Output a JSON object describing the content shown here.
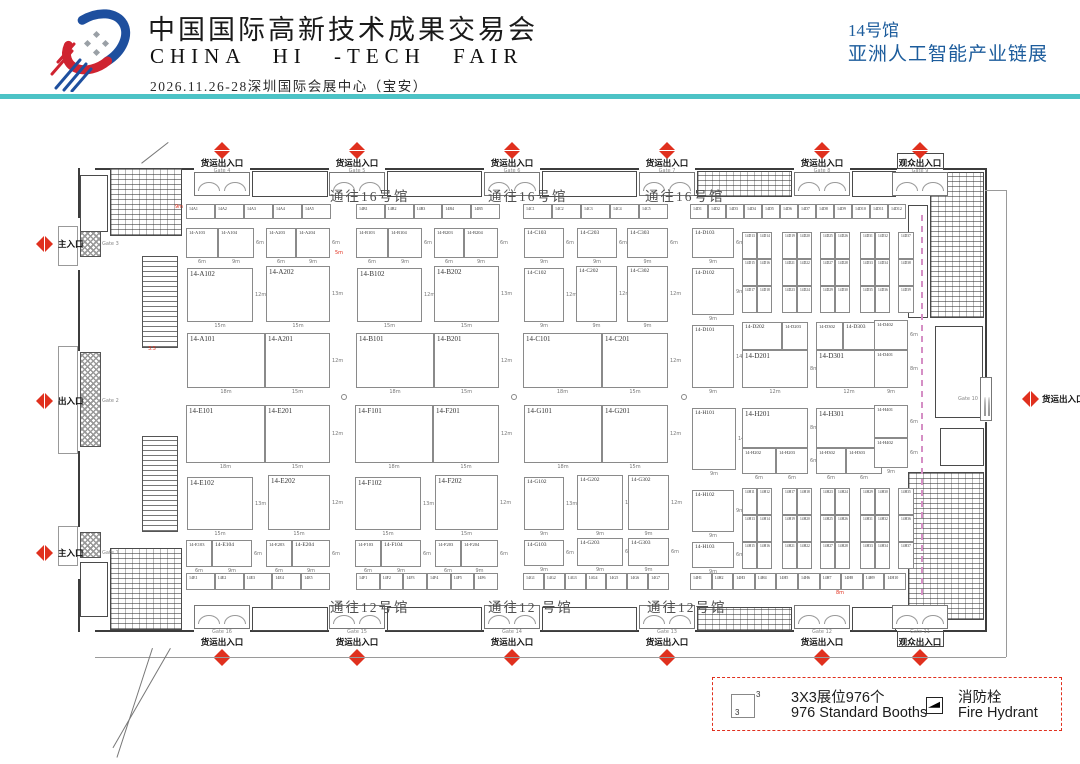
{
  "header": {
    "title_cn": "中国国际高新技术成果交易会",
    "title_en": "CHINA HI -TECH FAIR",
    "subtitle": "2026.11.26-28深圳国际会展中心（宝安）",
    "hall_no": "14号馆",
    "hall_name": "亚洲人工智能产业链展"
  },
  "colors": {
    "accent_teal": "#4cc3c6",
    "header_blue": "#1c5c9c",
    "marker_red": "#e0301e",
    "dashed_pink": "#d58fc5"
  },
  "legend": {
    "booth_icon_label": "3",
    "booth_icon_sup": "3",
    "item1_cn": "3X3展位976个",
    "item1_en": "976 Standard Booths",
    "item2_cn": "消防栓",
    "item2_en": "Fire Hydrant"
  },
  "plan": {
    "corridor_labels": [
      {
        "text": "通往16号馆",
        "x": 330,
        "y": 185
      },
      {
        "text": "通往16号馆",
        "x": 488,
        "y": 185
      },
      {
        "text": "通往16号馆",
        "x": 645,
        "y": 185
      },
      {
        "text": "通往12号馆",
        "x": 330,
        "y": 596
      },
      {
        "text": "通往12 号馆",
        "x": 488,
        "y": 596
      },
      {
        "text": "通往12号馆",
        "x": 647,
        "y": 596
      }
    ],
    "gates_top": [
      {
        "name": "货运出入口",
        "gate": "Gate 4",
        "x": 222
      },
      {
        "name": "货运出入口",
        "gate": "Gate 5",
        "x": 357
      },
      {
        "name": "货运出入口",
        "gate": "Gate 6",
        "x": 512
      },
      {
        "name": "货运出入口",
        "gate": "Gate 7",
        "x": 667
      },
      {
        "name": "货运出入口",
        "gate": "Gate 8",
        "x": 822
      },
      {
        "name": "观众出入口",
        "gate": "Gate 9",
        "x": 920
      }
    ],
    "gates_bottom": [
      {
        "name": "货运出入口",
        "gate": "Gate 16",
        "x": 222
      },
      {
        "name": "货运出入口",
        "gate": "Gate 15",
        "x": 357
      },
      {
        "name": "货运出入口",
        "gate": "Gate 14",
        "x": 512
      },
      {
        "name": "货运出入口",
        "gate": "Gate 13",
        "x": 667
      },
      {
        "name": "货运出入口",
        "gate": "Gate 12",
        "x": 822
      },
      {
        "name": "观众出入口",
        "gate": "Gate 11",
        "x": 920
      }
    ],
    "gates_left": [
      {
        "name": "主入口",
        "gate": "Gate 3",
        "y": 244
      },
      {
        "name": "出入口",
        "gate": "Gate 2",
        "y": 401
      },
      {
        "name": "主入口",
        "gate": "Gate 1",
        "y": 553
      }
    ],
    "gates_right": [
      {
        "name": "货运出入口",
        "gate": "Gate 10",
        "y": 399
      }
    ],
    "red_dims": [
      {
        "t": "9m",
        "x": 175,
        "y": 204
      },
      {
        "t": "5m",
        "x": 335,
        "y": 250
      },
      {
        "t": "3.5",
        "x": 148,
        "y": 346
      },
      {
        "t": "8m",
        "x": 836,
        "y": 590
      }
    ],
    "booths": [
      {
        "id": "14-A103",
        "x": 186,
        "y": 228,
        "w": 32,
        "h": 30,
        "wm": "6m"
      },
      {
        "id": "14-A104",
        "x": 218,
        "y": 228,
        "w": 36,
        "h": 30,
        "wm": "9m",
        "hm": "6m"
      },
      {
        "id": "14-A203",
        "x": 266,
        "y": 228,
        "w": 30,
        "h": 30,
        "wm": "6m"
      },
      {
        "id": "14-A204",
        "x": 296,
        "y": 228,
        "w": 34,
        "h": 30,
        "wm": "9m",
        "hm": "6m"
      },
      {
        "id": "14-A102",
        "x": 187,
        "y": 268,
        "w": 66,
        "h": 54,
        "wm": "15m",
        "hm": "12m"
      },
      {
        "id": "14-A202",
        "x": 266,
        "y": 266,
        "w": 64,
        "h": 56,
        "wm": "15m",
        "hm": "13m"
      },
      {
        "id": "14-A101",
        "x": 187,
        "y": 333,
        "w": 78,
        "h": 55,
        "wm": "18m"
      },
      {
        "id": "14-A201",
        "x": 265,
        "y": 333,
        "w": 65,
        "h": 55,
        "wm": "15m",
        "hm": "12m"
      },
      {
        "id": "14-B103",
        "x": 356,
        "y": 228,
        "w": 32,
        "h": 30,
        "wm": "6m"
      },
      {
        "id": "14-B104",
        "x": 388,
        "y": 228,
        "w": 34,
        "h": 30,
        "wm": "9m",
        "hm": "6m"
      },
      {
        "id": "14-B203",
        "x": 434,
        "y": 228,
        "w": 30,
        "h": 30,
        "wm": "6m"
      },
      {
        "id": "14-B204",
        "x": 464,
        "y": 228,
        "w": 34,
        "h": 30,
        "wm": "9m",
        "hm": "6m"
      },
      {
        "id": "14-B102",
        "x": 357,
        "y": 268,
        "w": 65,
        "h": 54,
        "wm": "15m",
        "hm": "12m"
      },
      {
        "id": "14-B202",
        "x": 434,
        "y": 266,
        "w": 65,
        "h": 56,
        "wm": "15m",
        "hm": "13m"
      },
      {
        "id": "14-B101",
        "x": 356,
        "y": 333,
        "w": 78,
        "h": 55,
        "wm": "18m"
      },
      {
        "id": "14-B201",
        "x": 434,
        "y": 333,
        "w": 65,
        "h": 55,
        "wm": "15m",
        "hm": "12m"
      },
      {
        "id": "14-C103",
        "x": 524,
        "y": 228,
        "w": 40,
        "h": 30,
        "wm": "9m",
        "hm": "6m"
      },
      {
        "id": "14-C203",
        "x": 577,
        "y": 228,
        "w": 40,
        "h": 30,
        "wm": "9m",
        "hm": "6m"
      },
      {
        "id": "14-C303",
        "x": 627,
        "y": 228,
        "w": 41,
        "h": 30,
        "wm": "9m",
        "hm": "6m"
      },
      {
        "id": "14-C102",
        "x": 524,
        "y": 268,
        "w": 40,
        "h": 54,
        "wm": "9m",
        "hm": "12m"
      },
      {
        "id": "14-C202",
        "x": 576,
        "y": 266,
        "w": 41,
        "h": 56,
        "wm": "9m",
        "hm": "12m"
      },
      {
        "id": "14-C302",
        "x": 627,
        "y": 266,
        "w": 41,
        "h": 56,
        "wm": "9m",
        "hm": "12m"
      },
      {
        "id": "14-C101",
        "x": 523,
        "y": 333,
        "w": 79,
        "h": 55,
        "wm": "18m"
      },
      {
        "id": "14-C201",
        "x": 602,
        "y": 333,
        "w": 66,
        "h": 55,
        "wm": "15m",
        "hm": "12m"
      },
      {
        "id": "14-D103",
        "x": 692,
        "y": 228,
        "w": 42,
        "h": 30,
        "wm": "9m",
        "hm": "6m"
      },
      {
        "id": "14-D102",
        "x": 692,
        "y": 268,
        "w": 42,
        "h": 47,
        "wm": "9m",
        "hm": "9m"
      },
      {
        "id": "14-D101",
        "x": 692,
        "y": 325,
        "w": 42,
        "h": 63,
        "wm": "9m",
        "hm": "14m"
      },
      {
        "id": "14-D202",
        "x": 742,
        "y": 322,
        "w": 40,
        "h": 28,
        "hm": "6m"
      },
      {
        "id": "14-D203",
        "x": 782,
        "y": 322,
        "w": 26,
        "h": 28
      },
      {
        "id": "14-D201",
        "x": 742,
        "y": 350,
        "w": 66,
        "h": 38,
        "wm": "12m",
        "hm": "8m"
      },
      {
        "id": "14-D302",
        "x": 816,
        "y": 322,
        "w": 27,
        "h": 28
      },
      {
        "id": "14-D303",
        "x": 843,
        "y": 322,
        "w": 39,
        "h": 28,
        "hm": "6m"
      },
      {
        "id": "14-D301",
        "x": 816,
        "y": 350,
        "w": 66,
        "h": 38,
        "wm": "12m",
        "hm": "8m"
      },
      {
        "id": "14-D402",
        "x": 874,
        "y": 320,
        "w": 34,
        "h": 30,
        "wm": "9m",
        "hm": "6m"
      },
      {
        "id": "14-D401",
        "x": 874,
        "y": 350,
        "w": 34,
        "h": 38,
        "wm": "9m",
        "hm": "8m"
      },
      {
        "id": "14-E101",
        "x": 186,
        "y": 405,
        "w": 79,
        "h": 58,
        "wm": "18m"
      },
      {
        "id": "14-E201",
        "x": 265,
        "y": 405,
        "w": 65,
        "h": 58,
        "wm": "15m",
        "hm": "12m"
      },
      {
        "id": "14-E102",
        "x": 187,
        "y": 477,
        "w": 66,
        "h": 53,
        "wm": "15m",
        "hm": "13m"
      },
      {
        "id": "14-E202",
        "x": 268,
        "y": 475,
        "w": 62,
        "h": 55,
        "wm": "15m",
        "hm": "12m"
      },
      {
        "id": "14-E103",
        "x": 186,
        "y": 540,
        "w": 26,
        "h": 27,
        "wm": "6m"
      },
      {
        "id": "14-E104",
        "x": 212,
        "y": 540,
        "w": 40,
        "h": 27,
        "wm": "9m",
        "hm": "6m"
      },
      {
        "id": "14-E203",
        "x": 266,
        "y": 540,
        "w": 26,
        "h": 27,
        "wm": "6m"
      },
      {
        "id": "14-E204",
        "x": 292,
        "y": 540,
        "w": 38,
        "h": 27,
        "wm": "9m",
        "hm": "6m"
      },
      {
        "id": "14-F101",
        "x": 355,
        "y": 405,
        "w": 78,
        "h": 58,
        "wm": "18m"
      },
      {
        "id": "14-F201",
        "x": 433,
        "y": 405,
        "w": 66,
        "h": 58,
        "wm": "15m",
        "hm": "12m"
      },
      {
        "id": "14-F102",
        "x": 355,
        "y": 477,
        "w": 66,
        "h": 53,
        "wm": "15m",
        "hm": "13m"
      },
      {
        "id": "14-F202",
        "x": 435,
        "y": 475,
        "w": 63,
        "h": 55,
        "wm": "15m",
        "hm": "12m"
      },
      {
        "id": "14-F103",
        "x": 355,
        "y": 540,
        "w": 26,
        "h": 27,
        "wm": "6m"
      },
      {
        "id": "14-F104",
        "x": 381,
        "y": 540,
        "w": 40,
        "h": 27,
        "wm": "9m",
        "hm": "6m"
      },
      {
        "id": "14-F203",
        "x": 435,
        "y": 540,
        "w": 26,
        "h": 27,
        "wm": "6m"
      },
      {
        "id": "14-F204",
        "x": 461,
        "y": 540,
        "w": 37,
        "h": 27,
        "wm": "9m",
        "hm": "6m"
      },
      {
        "id": "14-G101",
        "x": 524,
        "y": 405,
        "w": 78,
        "h": 58,
        "wm": "18m"
      },
      {
        "id": "14-G201",
        "x": 602,
        "y": 405,
        "w": 66,
        "h": 58,
        "wm": "15m",
        "hm": "12m"
      },
      {
        "id": "14-G102",
        "x": 524,
        "y": 477,
        "w": 40,
        "h": 53,
        "wm": "9m",
        "hm": "13m"
      },
      {
        "id": "14-G202",
        "x": 577,
        "y": 475,
        "w": 46,
        "h": 55,
        "wm": "9m",
        "hm": "12m"
      },
      {
        "id": "14-G302",
        "x": 628,
        "y": 475,
        "w": 41,
        "h": 55,
        "wm": "9m",
        "hm": "12m"
      },
      {
        "id": "14-G103",
        "x": 524,
        "y": 540,
        "w": 40,
        "h": 26,
        "wm": "9m",
        "hm": "6m"
      },
      {
        "id": "14-G203",
        "x": 577,
        "y": 538,
        "w": 46,
        "h": 28,
        "wm": "9m",
        "hm": "6m"
      },
      {
        "id": "14-G303",
        "x": 628,
        "y": 538,
        "w": 41,
        "h": 28,
        "wm": "9m",
        "hm": "6m"
      },
      {
        "id": "14-H101",
        "x": 692,
        "y": 408,
        "w": 44,
        "h": 62,
        "wm": "9m",
        "hm": "14m"
      },
      {
        "id": "14-H201",
        "x": 742,
        "y": 408,
        "w": 66,
        "h": 40,
        "wm": "12m",
        "hm": "8m"
      },
      {
        "id": "14-H202",
        "x": 742,
        "y": 448,
        "w": 34,
        "h": 26,
        "wm": "6m"
      },
      {
        "id": "14-H203",
        "x": 776,
        "y": 448,
        "w": 32,
        "h": 26,
        "wm": "6m",
        "hm": "6m"
      },
      {
        "id": "14-H301",
        "x": 816,
        "y": 408,
        "w": 66,
        "h": 40,
        "wm": "12m",
        "hm": "8m"
      },
      {
        "id": "14-H302",
        "x": 816,
        "y": 448,
        "w": 30,
        "h": 26,
        "wm": "6m"
      },
      {
        "id": "14-H303",
        "x": 846,
        "y": 448,
        "w": 36,
        "h": 26,
        "wm": "6m",
        "hm": "6m"
      },
      {
        "id": "14-H401",
        "x": 874,
        "y": 405,
        "w": 34,
        "h": 33,
        "wm": "9m",
        "hm": "6m"
      },
      {
        "id": "14-H402",
        "x": 874,
        "y": 438,
        "w": 34,
        "h": 30,
        "wm": "9m",
        "hm": "6m"
      },
      {
        "id": "14-H102",
        "x": 692,
        "y": 490,
        "w": 42,
        "h": 42,
        "wm": "9m",
        "hm": "9m"
      },
      {
        "id": "14-H103",
        "x": 692,
        "y": 542,
        "w": 42,
        "h": 26,
        "wm": "9m",
        "hm": "6m"
      }
    ],
    "strips": [
      {
        "x": 186,
        "y": 204,
        "w": 145,
        "h": 15,
        "cells": [
          "14A1",
          "14A2",
          "14A3",
          "14A4",
          "14A5"
        ]
      },
      {
        "x": 356,
        "y": 204,
        "w": 144,
        "h": 15,
        "cells": [
          "14B1",
          "14B2",
          "14B3",
          "14B4",
          "14B5"
        ]
      },
      {
        "x": 523,
        "y": 204,
        "w": 145,
        "h": 15,
        "cells": [
          "14C1",
          "14C2",
          "14C3",
          "14C4",
          "14C5"
        ]
      },
      {
        "x": 690,
        "y": 204,
        "w": 216,
        "h": 15,
        "cells": [
          "14D1",
          "14D2",
          "14D3",
          "14D4",
          "14D5",
          "14D6",
          "14D7",
          "14D8",
          "14D9",
          "14D10",
          "14D11",
          "14D12"
        ]
      },
      {
        "x": 186,
        "y": 573,
        "w": 144,
        "h": 17,
        "cells": [
          "14E1",
          "14E2",
          "14E3",
          "14E4",
          "14E5"
        ]
      },
      {
        "x": 356,
        "y": 573,
        "w": 142,
        "h": 17,
        "cells": [
          "14F1",
          "14F2",
          "14F3",
          "14F4",
          "14F5",
          "14F6"
        ]
      },
      {
        "x": 523,
        "y": 573,
        "w": 146,
        "h": 17,
        "cells": [
          "14G1",
          "14G2",
          "14G3",
          "14G4",
          "14G5",
          "14G6",
          "14G7"
        ]
      },
      {
        "x": 690,
        "y": 573,
        "w": 216,
        "h": 17,
        "cells": [
          "14H1",
          "14H2",
          "14H3",
          "14H4",
          "14H5",
          "14H6",
          "14H7",
          "14H8",
          "14H9",
          "14H10"
        ]
      }
    ],
    "grids": [
      {
        "x": 742,
        "y": 232,
        "cellH": 27,
        "cols": [
          15,
          15
        ],
        "labels": [
          [
            "14D13",
            "14D14"
          ],
          [
            "14D15",
            "14D16"
          ],
          [
            "14D17",
            "14D18"
          ]
        ]
      },
      {
        "x": 782,
        "y": 232,
        "cellH": 27,
        "cols": [
          15,
          15
        ],
        "labels": [
          [
            "14D19",
            "14D20"
          ],
          [
            "14D21",
            "14D22"
          ],
          [
            "14D23",
            "14D24"
          ]
        ]
      },
      {
        "x": 820,
        "y": 232,
        "cellH": 27,
        "cols": [
          15,
          15
        ],
        "labels": [
          [
            "14D25",
            "14D26"
          ],
          [
            "14D27",
            "14D28"
          ],
          [
            "14D29",
            "14D30"
          ]
        ]
      },
      {
        "x": 860,
        "y": 232,
        "cellH": 27,
        "cols": [
          15,
          15
        ],
        "labels": [
          [
            "14D31",
            "14D32"
          ],
          [
            "14D33",
            "14D34"
          ],
          [
            "14D35",
            "14D36"
          ]
        ]
      },
      {
        "x": 898,
        "y": 232,
        "cellH": 27,
        "cols": [
          16
        ],
        "labels": [
          [
            "14D37"
          ],
          [
            "14D38"
          ],
          [
            "14D39"
          ]
        ]
      },
      {
        "x": 742,
        "y": 488,
        "cellH": 27,
        "cols": [
          15,
          15
        ],
        "labels": [
          [
            "14H11",
            "14H12"
          ],
          [
            "14H13",
            "14H14"
          ],
          [
            "14H15",
            "14H16"
          ]
        ]
      },
      {
        "x": 782,
        "y": 488,
        "cellH": 27,
        "cols": [
          15,
          15
        ],
        "labels": [
          [
            "14H17",
            "14H18"
          ],
          [
            "14H19",
            "14H20"
          ],
          [
            "14H21",
            "14H22"
          ]
        ]
      },
      {
        "x": 820,
        "y": 488,
        "cellH": 27,
        "cols": [
          15,
          15
        ],
        "labels": [
          [
            "14H23",
            "14H24"
          ],
          [
            "14H25",
            "14H26"
          ],
          [
            "14H27",
            "14H28"
          ]
        ]
      },
      {
        "x": 860,
        "y": 488,
        "cellH": 27,
        "cols": [
          15,
          15
        ],
        "labels": [
          [
            "14H29",
            "14H30"
          ],
          [
            "14H31",
            "14H32"
          ],
          [
            "14H33",
            "14H34"
          ]
        ]
      },
      {
        "x": 898,
        "y": 488,
        "cellH": 27,
        "cols": [
          16
        ],
        "labels": [
          [
            "14H35"
          ],
          [
            "14H36"
          ],
          [
            "14H37"
          ]
        ]
      }
    ]
  }
}
